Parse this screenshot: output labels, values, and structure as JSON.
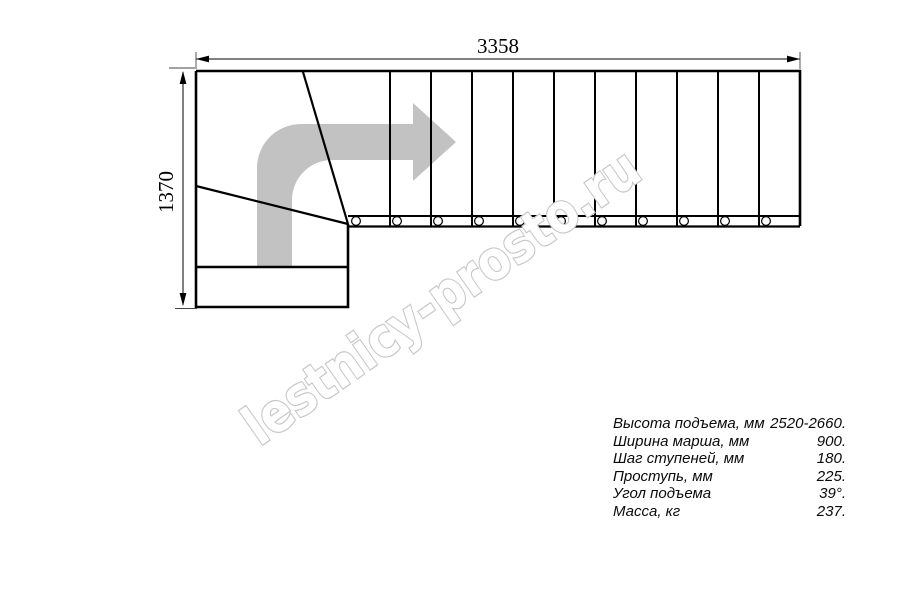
{
  "drawing": {
    "width_label": "3358",
    "height_label": "1370",
    "watermark": "lestnicy-prosto.ru",
    "straight_treads": 11,
    "winder_treads": 3,
    "colors": {
      "line": "#000000",
      "arrow_fill": "#c2c2c2",
      "watermark_outline": "#c7c7c7"
    }
  },
  "specs": {
    "rows": [
      {
        "label": "Высота подъема, мм",
        "value": "2520-2660."
      },
      {
        "label": "Ширина марша, мм",
        "value": "900."
      },
      {
        "label": "Шаг ступеней, мм",
        "value": "180."
      },
      {
        "label": "Проступь, мм",
        "value": "225."
      },
      {
        "label": "Угол подъема",
        "value": "39°."
      },
      {
        "label": "Масса, кг",
        "value": "237."
      }
    ]
  }
}
